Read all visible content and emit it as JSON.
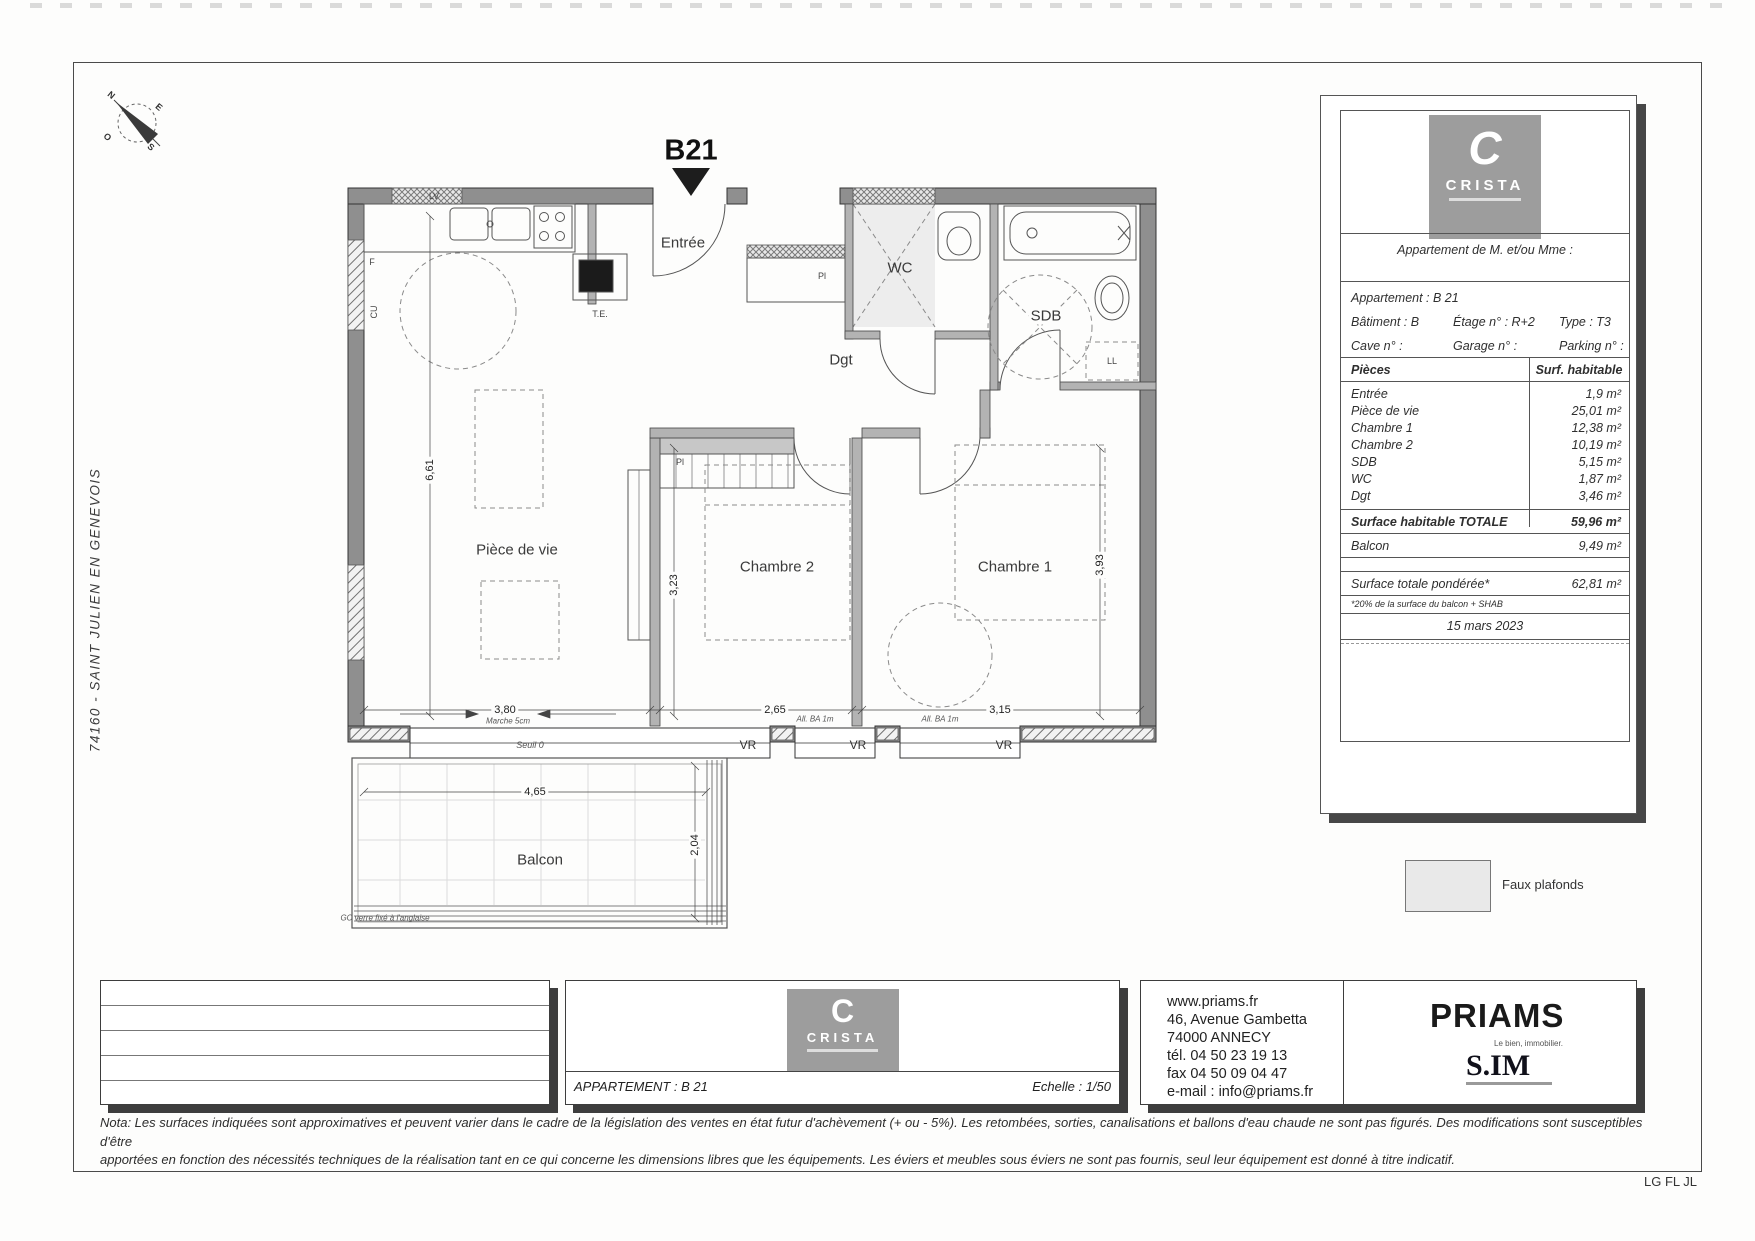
{
  "sheet": {
    "side_text": "74160  -  SAINT JULIEN EN GENEVOIS",
    "plan_title": "B21",
    "initials": "LG FL JL",
    "nota_line1": "Nota: Les surfaces indiquées sont approximatives et peuvent varier dans le cadre de la législation des ventes en état futur d'achèvement (+ ou - 5%). Les retombées, sorties, canalisations et ballons d'eau chaude ne sont pas figurés. Des modifications sont susceptibles d'être",
    "nota_line2": "apportées en fonction des nécessités techniques de la réalisation tant en ce qui concerne les dimensions libres que les équipements. Les éviers et meubles sous éviers ne sont pas fournis, seul leur équipement est donné à titre indicatif."
  },
  "compass": {
    "n": "N",
    "e": "E",
    "s": "S",
    "o": "O"
  },
  "plan": {
    "rooms": {
      "entree": "Entrée",
      "wc": "WC",
      "sdb": "SDB",
      "dgt": "Dgt",
      "piece_de_vie": "Pièce de vie",
      "chambre2": "Chambre 2",
      "chambre1": "Chambre 1",
      "balcon": "Balcon"
    },
    "fixture_labels": {
      "lv": "LV",
      "f": "F",
      "cu": "CU",
      "te": "T.E.",
      "pl1": "Pl",
      "pl2": "Pl",
      "ll": "LL"
    },
    "dimensions": {
      "living_width": "3,80",
      "ch2_width": "2,65",
      "ch1_width": "3,15",
      "living_height": "6,61",
      "ch2_height": "3,23",
      "ch1_height": "3,93",
      "balcony_width": "4,65",
      "balcony_depth": "2,04"
    },
    "notes": {
      "marche": "Marche 5cm",
      "seuil": "Seuil 0",
      "vr": "VR",
      "all_ba1": "All. BA 1m",
      "all_ba2": "All. BA 1m",
      "gc": "GC verre fixé à l'anglaise"
    }
  },
  "title_block": {
    "brand_initial": "C",
    "brand_name": "CRISTA",
    "header": "Appartement de M. et/ou Mme :",
    "info": {
      "apartment": "Appartement : B 21",
      "building": "Bâtiment : B",
      "floor": "Étage n° : R+2",
      "type": "Type : T3",
      "cave": "Cave n° :",
      "garage": "Garage n° :",
      "parking": "Parking n° :"
    },
    "table": {
      "col_rooms": "Pièces",
      "col_area": "Surf. habitable",
      "rows": [
        {
          "label": "Entrée",
          "value": "1,9 m²"
        },
        {
          "label": "Pièce de vie",
          "value": "25,01 m²"
        },
        {
          "label": "Chambre 1",
          "value": "12,38 m²"
        },
        {
          "label": "Chambre 2",
          "value": "10,19 m²"
        },
        {
          "label": "SDB",
          "value": "5,15 m²"
        },
        {
          "label": "WC",
          "value": "1,87 m²"
        },
        {
          "label": "Dgt",
          "value": "3,46 m²"
        }
      ],
      "total_label": "Surface habitable TOTALE",
      "total_value": "59,96 m²",
      "balcony_label": "Balcon",
      "balcony_value": "9,49 m²",
      "weighted_label": "Surface totale pondérée*",
      "weighted_value": "62,81 m²",
      "footnote": "*20% de la surface du balcon + SHAB",
      "date": "15 mars 2023"
    },
    "architect": "ATELIER PLURIEL"
  },
  "legend": {
    "faux_plafonds": "Faux plafonds"
  },
  "footer": {
    "apartment": "APPARTEMENT : B 21",
    "scale": "Echelle : 1/50",
    "brand_initial": "C",
    "brand_name": "CRISTA",
    "contact": [
      "www.priams.fr",
      "46, Avenue Gambetta",
      "74000 ANNECY",
      "tél. 04 50 23 19 13",
      "fax 04 50 09 04 47",
      "e-mail : info@priams.fr"
    ],
    "priams": "PRIAMS",
    "priams_tagline": "Le bien, immobilier.",
    "sim": "S.IM"
  }
}
